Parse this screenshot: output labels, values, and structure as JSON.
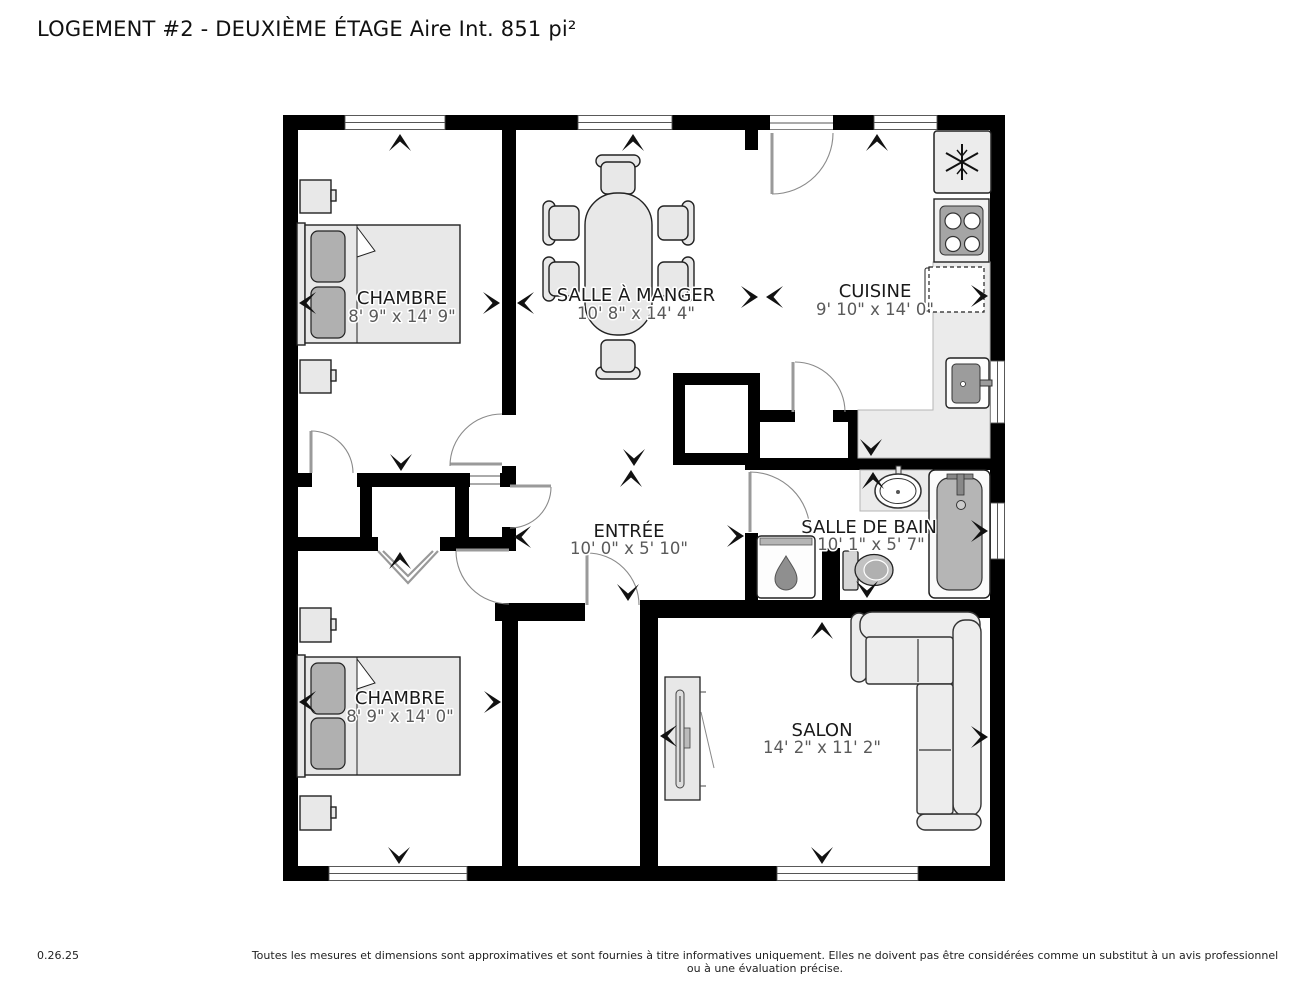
{
  "title": "LOGEMENT #2 - DEUXIÈME ÉTAGE Aire Int. 851 pi²",
  "rooms": [
    {
      "name": "CHAMBRE",
      "dims": "8' 9\" x 14' 9\""
    },
    {
      "name": "SALLE À MANGER",
      "dims": "10' 8\" x 14' 4\""
    },
    {
      "name": "CUISINE",
      "dims": "9' 10\" x 14' 0\""
    },
    {
      "name": "ENTRÉE",
      "dims": "10' 0\" x 5' 10\""
    },
    {
      "name": "SALLE DE BAIN",
      "dims": "10' 1\" x 5' 7\""
    },
    {
      "name": "CHAMBRE",
      "dims": "8' 9\" x 14' 0\""
    },
    {
      "name": "SALON",
      "dims": "14' 2\" x 11' 2\""
    }
  ],
  "footer": {
    "version": "0.26.25",
    "disclaimer": "Toutes les mesures et dimensions sont approximatives et sont fournies à titre informatives uniquement. Elles ne doivent pas être considérées comme un substitut à un avis professionnel ou à une évaluation précise."
  },
  "icons": {
    "fridge": "snowflake-icon",
    "stove": "four-burner-cooktop-icon",
    "dishwasher": "dashed-appliance-icon",
    "water_heater": "water-drop-icon"
  },
  "furniture": [
    "bed",
    "pillow",
    "nightstand",
    "dining-table",
    "dining-chair",
    "fridge",
    "stove",
    "dishwasher",
    "kitchen-counter",
    "kitchen-sink",
    "bathroom-sink",
    "bathtub",
    "toilet",
    "water-heater",
    "sofa-sectional",
    "tv-stand"
  ],
  "colors": {
    "wall": "#000000",
    "floor": "#ffffff",
    "furniture_light": "#e8e8e8",
    "furniture_dark": "#b0b0b0",
    "counter": "#ebebeb",
    "room_label": "#1a1a1a",
    "dimension_text": "#5a5a5a"
  }
}
